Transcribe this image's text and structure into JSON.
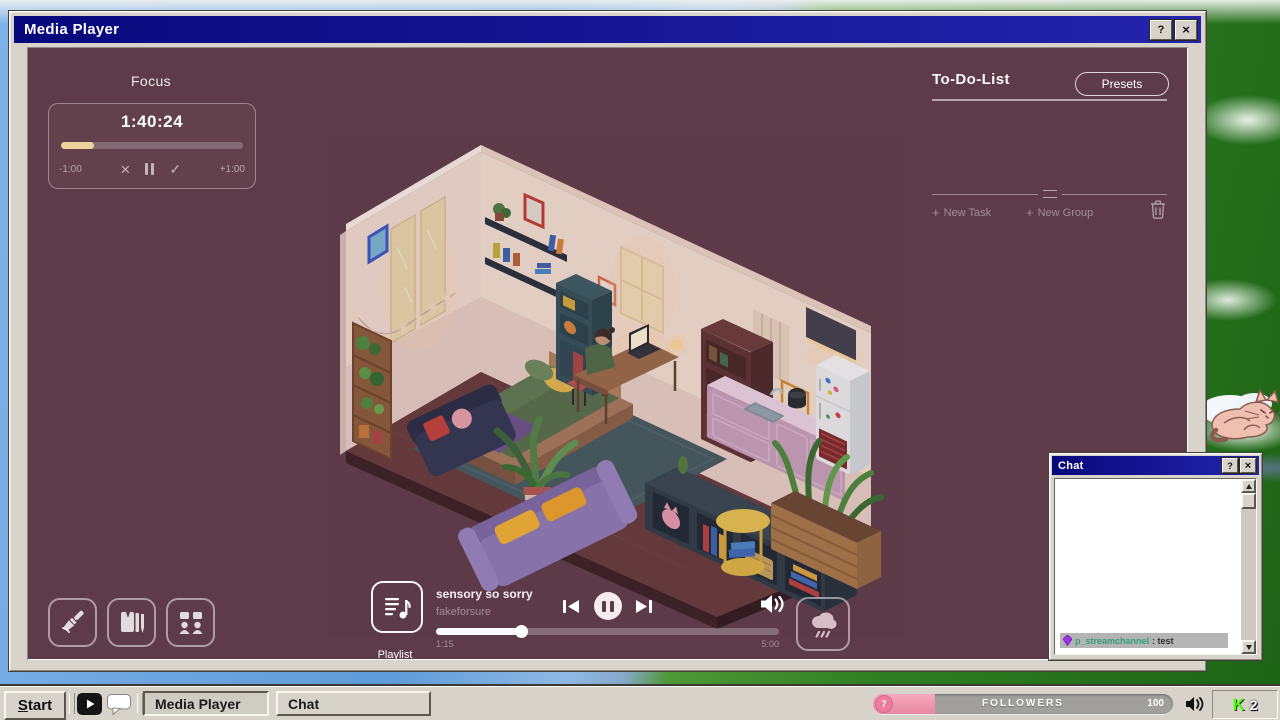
{
  "media_player": {
    "title": "Media Player",
    "help_label": "?",
    "close_label": "×",
    "focus": {
      "heading": "Focus",
      "time": "1:40:24",
      "progress_pct": 18,
      "subtract_label": "-1:00",
      "add_label": "+1:00",
      "cancel_glyph": "×",
      "check_glyph": "✓"
    },
    "todo": {
      "heading": "To-Do-List",
      "presets_label": "Presets",
      "plus_glyph": "+",
      "new_task_label": "New Task",
      "new_group_label": "New Group"
    },
    "player": {
      "song_title": "sensory so sorry",
      "artist": "fakeforsure",
      "elapsed": "1:15",
      "duration": "5:00",
      "progress_pct": 25,
      "playlist_label": "Playlist"
    }
  },
  "chat": {
    "title": "Chat",
    "help_label": "?",
    "close_label": "×",
    "message": {
      "username": "p_streamchannel",
      "text": ": test"
    }
  },
  "taskbar": {
    "start_label": "Start",
    "media_player_label": "Media Player",
    "chat_label": "Chat",
    "followers": {
      "current": "7",
      "label": "FOLLOWERS",
      "total": "100"
    },
    "tray": {
      "logo": "K",
      "viewer_count": "2"
    }
  },
  "colors": {
    "plum_background": "#5d3b48",
    "title_navy": "#08087c",
    "accent_cream": "#ecd49c",
    "followers_pink": "#ee9db6",
    "kick_green": "#53fc18",
    "chat_username_teal": "#2f9e7c"
  }
}
